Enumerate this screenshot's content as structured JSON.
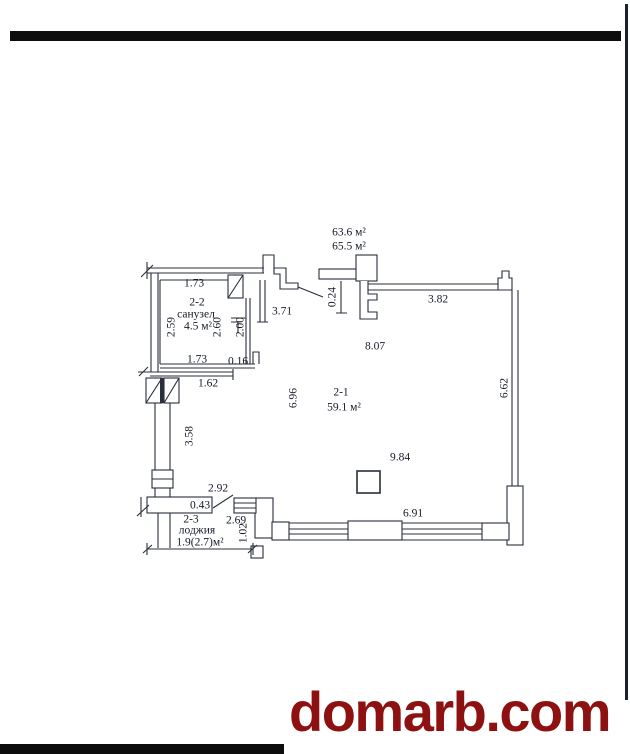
{
  "watermark": {
    "text": "domarb.com",
    "color": "#8e1111"
  },
  "scan": {
    "bar_color": "#0d0d0d",
    "right_border_color": "#1b2130"
  },
  "plan": {
    "line_color": "#2a2f3e",
    "totals": {
      "upper": "63.6 м²",
      "lower": "65.5 м²"
    },
    "rooms": {
      "main": {
        "id": "2-1",
        "area": "59.1 м²"
      },
      "bathroom": {
        "id": "2-2",
        "name": "санузел",
        "area": "4.5 м²"
      },
      "loggia": {
        "id": "2-3",
        "name": "лоджия",
        "area": "1.9(2.7)м²"
      }
    },
    "dims": {
      "top_173": "1.73",
      "v_259": "2.59",
      "v_260": "2.60",
      "v_200": "2.00",
      "hall_371": "3.71",
      "bot_173": "1.73",
      "jog_016": "0.16",
      "below_162": "1.62",
      "v_024": "0.24",
      "top_382": "3.82",
      "mid_807": "8.07",
      "right_662": "6.62",
      "v_696": "6.96",
      "mid_984": "9.84",
      "bottom_691": "6.91",
      "left_358": "3.58",
      "loggia_292": "2.92",
      "loggia_043": "0.43",
      "loggia_269": "2.69",
      "v_102": "1.02"
    }
  }
}
